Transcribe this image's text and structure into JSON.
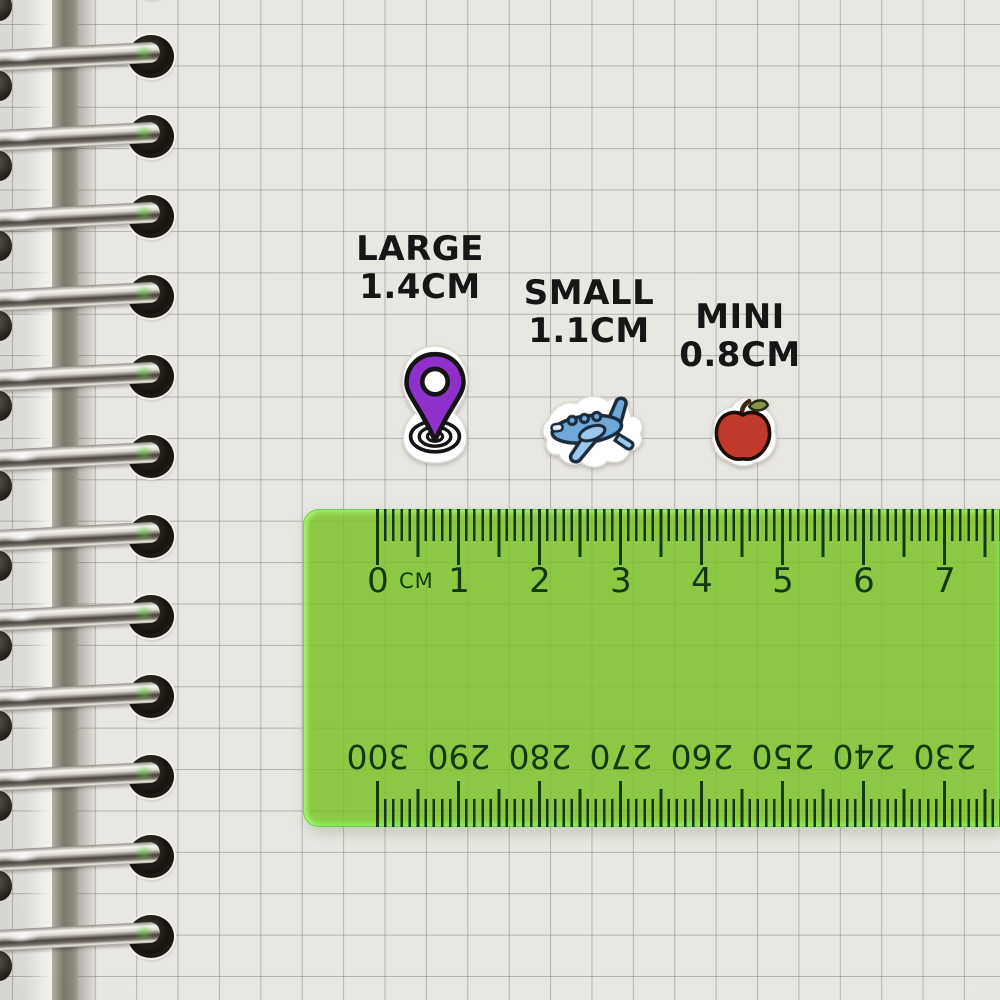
{
  "meta": {
    "scene": "Sticker size comparison photographed on a squared spiral-notebook page with a transparent green ruler"
  },
  "size_labels": [
    {
      "id": "large",
      "name": "LARGE",
      "size": "1.4CM"
    },
    {
      "id": "small",
      "name": "SMALL",
      "size": "1.1CM"
    },
    {
      "id": "mini",
      "name": "MINI",
      "size": "0.8CM"
    }
  ],
  "stickers": [
    {
      "id": "location-pin",
      "label": "LARGE",
      "size_cm": 1.4,
      "colors": {
        "primary": "#8e30c9",
        "outline": "#141414",
        "die_cut": "#ffffff"
      }
    },
    {
      "id": "airplane",
      "label": "SMALL",
      "size_cm": 1.1,
      "colors": {
        "primary": "#6fa9d9",
        "secondary": "#9cc8ec",
        "outline": "#1c2b3a",
        "die_cut": "#ffffff"
      }
    },
    {
      "id": "apple",
      "label": "MINI",
      "size_cm": 0.8,
      "colors": {
        "primary": "#bf3a2b",
        "leaf": "#87914a",
        "stem": "#3c2a12",
        "outline": "#1d0b06",
        "die_cut": "#ffffff"
      }
    }
  ],
  "ruler": {
    "unit_label": "CM",
    "top_scale_numbers": [
      "0",
      "1",
      "2",
      "3",
      "4",
      "5",
      "6",
      "7"
    ],
    "bottom_scale_numbers": [
      "300",
      "290",
      "280",
      "270",
      "260",
      "250",
      "240",
      "230"
    ],
    "body_color": "#8cc63c",
    "edge_color": "#46d546",
    "mark_color": "#15380e"
  },
  "notebook": {
    "paper_color": "#e9e7e2",
    "grid_color": "#a9a8a2",
    "binding_style": "silver-metal-rings",
    "ring_count": 13
  }
}
